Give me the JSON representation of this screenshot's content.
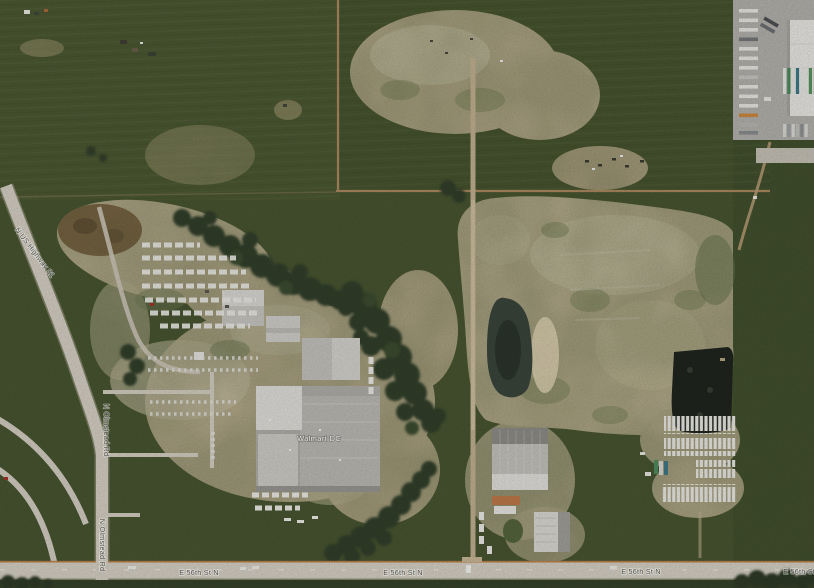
{
  "map": {
    "labels": {
      "highway": "N US Highway 81",
      "north_road_a": "N Olmstead Rd",
      "north_road_b": "N Olmstead Rd",
      "cross_street_a": "E 56th St N",
      "cross_street_b": "E 56th St N",
      "cross_street_c": "E 56th St N",
      "cross_street_d": "E 56th St N",
      "building": "Walmart DC"
    },
    "colors": {
      "field_green": "#4a5732",
      "field_green_light": "#4f5b34",
      "dirt_tan": "#cfc0a1",
      "dirt_bright": "#ddd2b4",
      "road_gray": "#d8d2c6",
      "section_line": "#ad8a60",
      "pond": "#3a463c",
      "asphalt_dark": "#20251e",
      "concrete_yard": "#b5b3ae",
      "building_white": "#eceae6",
      "building_gray": "#b2b0ab",
      "edge_stripe_orange": "#c2854e"
    }
  }
}
